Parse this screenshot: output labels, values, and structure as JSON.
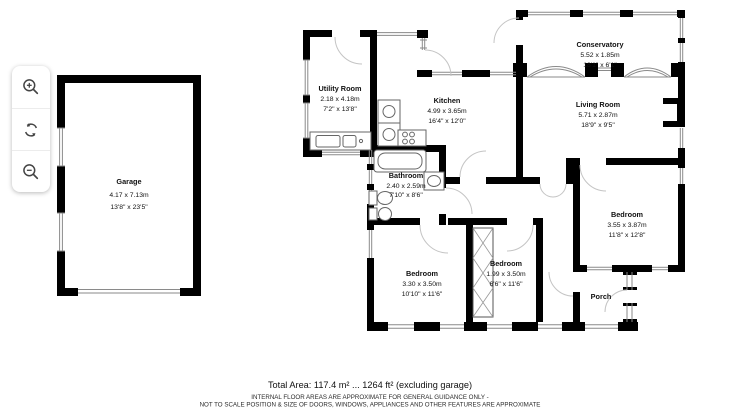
{
  "controls": {
    "zoom_in_icon": "magnifier-plus",
    "rotate_icon": "circular-arrows",
    "zoom_out_icon": "magnifier-minus"
  },
  "rooms": {
    "garage": {
      "name": "Garage",
      "metric": "4.17 x 7.13m",
      "imperial": "13'8\" x 23'5\""
    },
    "utility": {
      "name": "Utility Room",
      "metric": "2.18 x 4.18m",
      "imperial": "7'2\" x 13'8\""
    },
    "kitchen": {
      "name": "Kitchen",
      "metric": "4.99 x 3.65m",
      "imperial": "16'4\" x 12'0\""
    },
    "conservatory": {
      "name": "Conservatory",
      "metric": "5.52 x 1.85m",
      "imperial": "18'1\" x 6'1\""
    },
    "living": {
      "name": "Living Room",
      "metric": "5.71 x 2.87m",
      "imperial": "18'9\" x 9'5\""
    },
    "bathroom": {
      "name": "Bathroom",
      "metric": "2.40 x 2.59m",
      "imperial": "7'10\" x 8'6\""
    },
    "bedroom_right": {
      "name": "Bedroom",
      "metric": "3.55 x 3.87m",
      "imperial": "11'8\" x 12'8\""
    },
    "bedroom_left": {
      "name": "Bedroom",
      "metric": "3.30 x 3.50m",
      "imperial": "10'10\" x 11'6\""
    },
    "bedroom_mid": {
      "name": "Bedroom",
      "metric": "1.99 x 3.50m",
      "imperial": "6'6\" x 11'6\""
    },
    "porch": {
      "name": "Porch"
    }
  },
  "footer": {
    "total_area": "Total Area: 117.4 m² ... 1264 ft² (excluding garage)",
    "disclaimer_line1": "INTERNAL FLOOR AREAS ARE APPROXIMATE FOR GENERAL GUIDANCE ONLY -",
    "disclaimer_line2": "NOT TO SCALE POSITION & SIZE OF DOORS, WINDOWS, APPLIANCES AND OTHER FEATURES ARE APPROXIMATE"
  },
  "colors": {
    "wall": "#000000",
    "background": "#ffffff",
    "window_line": "#8a8a8a",
    "door_arc": "#c4c4c4",
    "fixture": "#666666"
  }
}
